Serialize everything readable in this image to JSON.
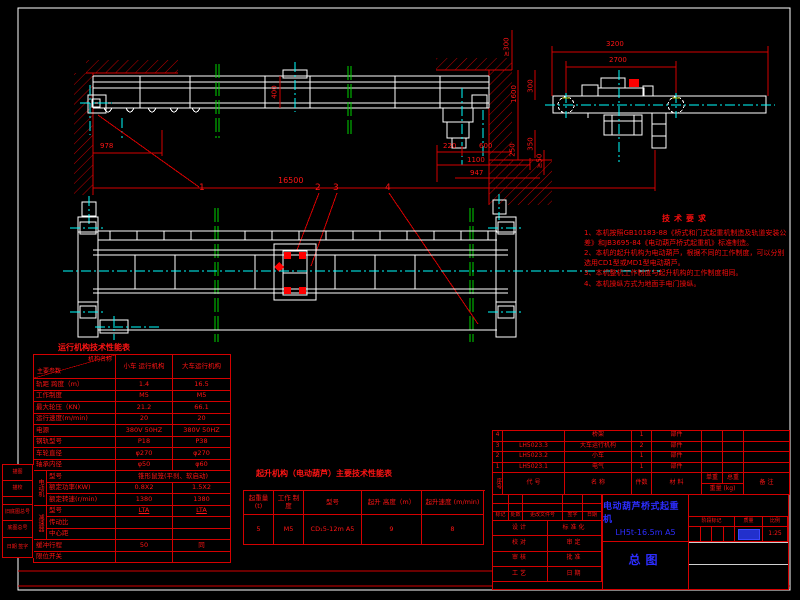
{
  "elevation": {
    "dim_978": "978",
    "dim_16500": "16500",
    "dim_220": "220",
    "dim_600": "600",
    "dim_1100": "1100",
    "dim_947": "947",
    "dim_400": "400",
    "dim_ge300": "≥300",
    "dim_300": "300",
    "dim_1600": "1600",
    "dim_250": "250",
    "dim_350": "350",
    "dim_ge50": "≥50",
    "balloon_1": "1",
    "balloon_2": "2",
    "balloon_3": "3",
    "balloon_4": "4"
  },
  "end_view": {
    "dim_3200": "3200",
    "dim_2700": "2700"
  },
  "tech_notes": {
    "title": "技术要求",
    "lines": [
      "1、本机按照GB10183-88《桥式和门式起重机制造及轨道安装公差》和JB3695-84《电动葫芦桥式起重机》标准制造。",
      "2、本机的起升机构为电动葫芦，根据不同的工作制度，可以分别选用CD1型或MD1型电动葫芦。",
      "3、本机整机工作制度与起升机构的工作制度相同。",
      "4、本机操纵方式为地面手电门操纵。"
    ]
  },
  "run_table": {
    "title": "运行机构技术性能表",
    "corner_top": "机构名称",
    "corner_bottom": "主要参数",
    "col_small": "小车 运行机构",
    "col_big": "大车运行机构",
    "rows": [
      {
        "label": "轨距 跨度（m）",
        "v1": "1.4",
        "v2": "16.5"
      },
      {
        "label": "工作制度",
        "v1": "M5",
        "v2": "M5"
      },
      {
        "label": "最大轮压（KN）",
        "v1": "21.2",
        "v2": "66.1"
      },
      {
        "label": "运行速度(m/min)",
        "v1": "20",
        "v2": "20"
      },
      {
        "label": "电源",
        "v1": "380V 50HZ",
        "v2": "380V 50HZ"
      },
      {
        "label": "钢轨型号",
        "v1": "P18",
        "v2": "P38"
      },
      {
        "label": "车轮直径",
        "v1": "φ270",
        "v2": "φ270"
      },
      {
        "label": "轴承内径",
        "v1": "φ50",
        "v2": "φ60"
      }
    ],
    "motor_group": "电动机",
    "motor_rows": [
      {
        "label": "型号",
        "span": "锥形鼠笼(平刹、软启动)"
      },
      {
        "label": "额定功率(KW)",
        "v1": "0.8X2",
        "v2": "1.5X2"
      },
      {
        "label": "额定转速(r/min)",
        "v1": "1380",
        "v2": "1380"
      }
    ],
    "reducer_group": "减速器",
    "reducer_rows": [
      {
        "label": "型号",
        "v1": "LTA",
        "v2": "LTA"
      },
      {
        "label": "传动比",
        "v1": "",
        "v2": ""
      },
      {
        "label": "中心距",
        "v1": "",
        "v2": ""
      }
    ],
    "tail_rows": [
      {
        "label": "缓冲行程",
        "v1": "50",
        "v2": "同"
      },
      {
        "label": "限位开关",
        "v1": "",
        "v2": ""
      }
    ]
  },
  "hoist_table": {
    "title": "起升机构（电动葫芦）主要技术性能表",
    "headers": [
      "起重量 (t)",
      "工作 制度",
      "型号",
      "起升 高度（m）",
      "起升速度 (m/min)"
    ],
    "values": [
      "5",
      "M5",
      "CD₁5-12m A5",
      "9",
      "8"
    ]
  },
  "bom": {
    "headers": {
      "no": "序号",
      "code": "代  号",
      "name": "名  称",
      "qty": "件数",
      "material": "材  料",
      "unit": "单重",
      "total": "总重",
      "weight": "重量 (kg)",
      "note": "备  注"
    },
    "rows": [
      {
        "no": "4",
        "code": "",
        "name": "桥架",
        "qty": "1",
        "material": "部件",
        "unit": "",
        "total": "",
        "note": ""
      },
      {
        "no": "3",
        "code": "LH5023.3",
        "name": "大车运行机构",
        "qty": "2",
        "material": "部件",
        "unit": "",
        "total": "",
        "note": ""
      },
      {
        "no": "2",
        "code": "LH5023.2",
        "name": "小车",
        "qty": "1",
        "material": "部件",
        "unit": "",
        "total": "",
        "note": ""
      },
      {
        "no": "1",
        "code": "LH5023.1",
        "name": "电气",
        "qty": "1",
        "material": "部件",
        "unit": "",
        "total": "",
        "note": ""
      }
    ]
  },
  "title_block": {
    "product_name": "电动葫芦桥式起重机",
    "product_model": "LH5t-16.5m   A5",
    "sheet_name": "总图",
    "rev_headers": [
      "标记",
      "处数",
      "更改文件号",
      "签字",
      "日期"
    ],
    "sign_rows": [
      [
        "设计",
        "标准化"
      ],
      [
        "校对",
        "审定"
      ],
      [
        "审核",
        "批准"
      ],
      [
        "工艺",
        "日期"
      ]
    ],
    "stage_headers": [
      "阶段标记",
      "质量",
      "比例"
    ],
    "scale": "1:25"
  },
  "margin_blocks": {
    "rows": [
      "描图",
      "描校",
      "",
      "旧底图总号",
      "底图总号",
      "日期  签字"
    ]
  }
}
